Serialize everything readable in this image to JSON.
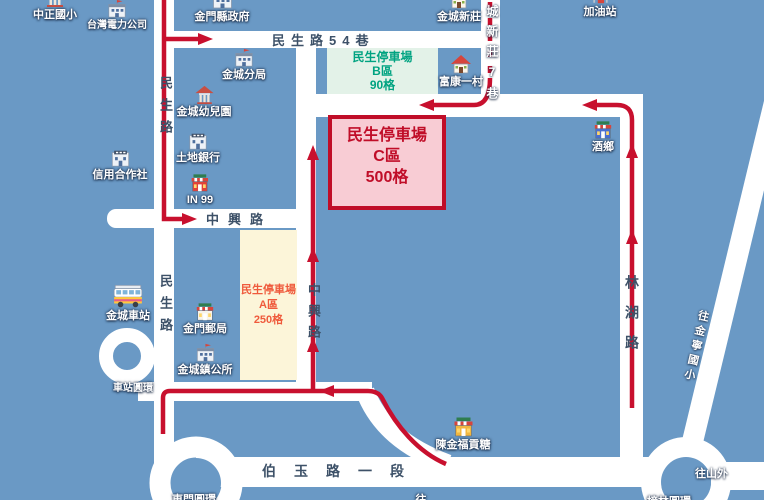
{
  "colors": {
    "background": "#6a99c5",
    "road": "#ffffff",
    "route_red": "#c8102e",
    "road_label": "#3d5168",
    "parking_b_bg": "#e3f2e8",
    "parking_b_fg": "#00a381",
    "parking_c_bg": "#f8ccd4",
    "parking_c_fg": "#c00d28",
    "parking_a_bg": "#fcf5d9",
    "parking_a_fg": "#ef5a3c"
  },
  "parking": {
    "b": {
      "title": "民生停車場",
      "zone": "B區",
      "capacity": "90格"
    },
    "c": {
      "title": "民生停車場",
      "zone": "C區",
      "capacity": "500格"
    },
    "a": {
      "title": "民生停車場",
      "zone": "A區",
      "capacity": "250格"
    }
  },
  "roads": {
    "minsheng_upper": "民生路",
    "minsheng_lower": "民生路",
    "lane54": "民生路54巷",
    "zhongxing_h": "中興路",
    "zhongxing_v": "中興路",
    "linhu": "林湖路",
    "boyu_sec1": "伯玉路一段",
    "xinzhuang_lane7": "城新莊7巷",
    "to_jinning_elementary": "往金寧國小",
    "to_shanwai": "往山外"
  },
  "roundabouts": {
    "station": "車站圓環",
    "dongmen": "東門圓環",
    "banglin": "榜林圓環"
  },
  "partial_label": "往",
  "pois": {
    "zhongzheng_elementary": "中正國小",
    "taipower": "台灣電力公司",
    "county_government": "金門縣政府",
    "jincheng_xinzhuang": "金城新莊",
    "gas_station": "加油站",
    "jincheng_police_branch": "金城分局",
    "jincheng_kindergarten": "金城幼兒園",
    "fukang_village": "富康一村",
    "wine_town": "酒鄉",
    "credit_cooperative": "信用合作社",
    "land_bank": "土地銀行",
    "in99": "IN 99",
    "kinmen_post_office": "金門郵局",
    "jincheng_township_office": "金城鎮公所",
    "jincheng_bus_station": "金城車站",
    "chen_jin_fu_congtang": "陳金福貢糖"
  }
}
